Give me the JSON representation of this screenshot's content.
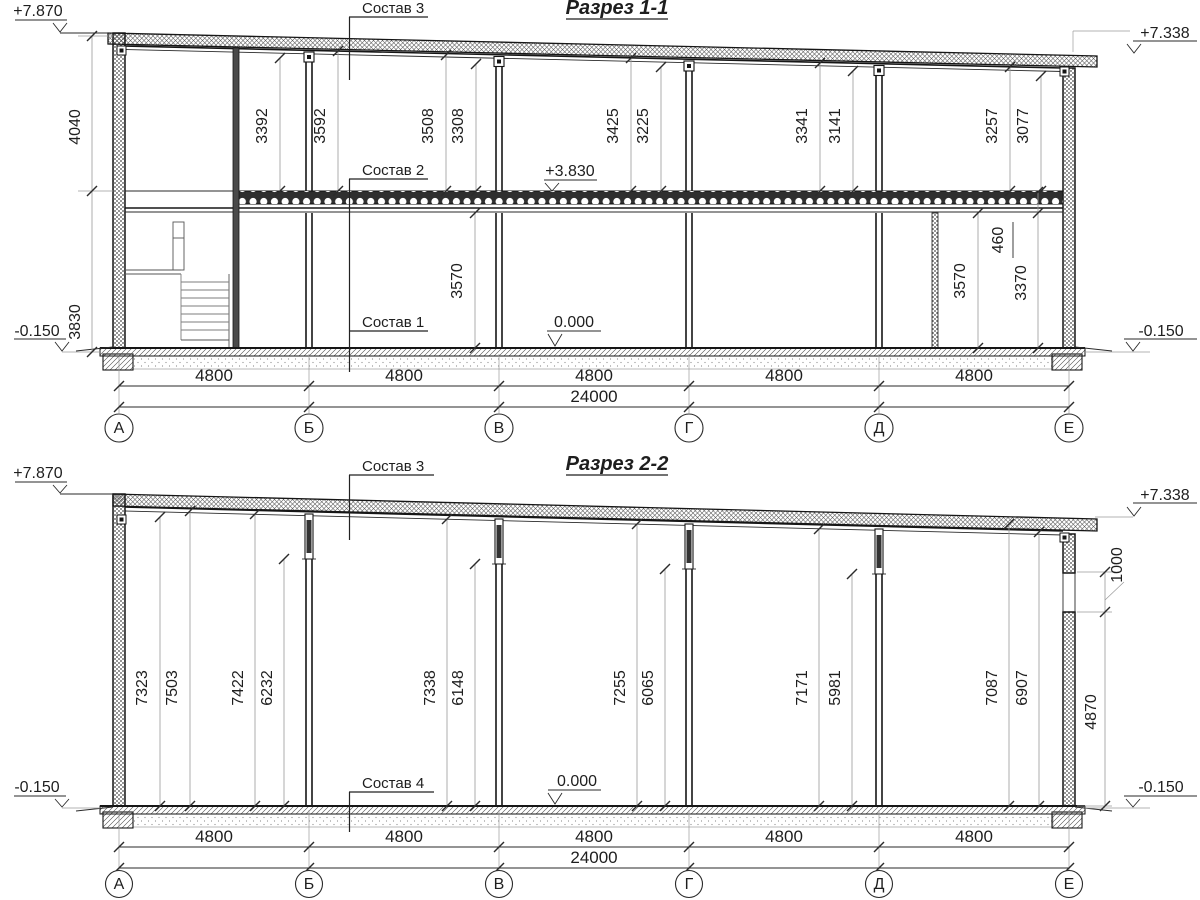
{
  "drawing": {
    "s1": {
      "title": "Разрез 1-1",
      "labels": {
        "l1": "Состав 1",
        "l2": "Состав 2",
        "l3": "Состав 3"
      },
      "elev": {
        "tl": "+7.870",
        "tr": "+7.338",
        "bl": "-0.150",
        "br": "-0.150",
        "zero": "0.000",
        "mid": "+3.830"
      },
      "side": {
        "upper": "4040",
        "lower": "3830"
      },
      "up": [
        "3392",
        "3592",
        "3508",
        "3308",
        "3425",
        "3225",
        "3341",
        "3141",
        "3257",
        "3077"
      ],
      "low": {
        "a": "3570",
        "b": "3570",
        "c": "3370",
        "d": "460"
      },
      "span": [
        "4800",
        "4800",
        "4800",
        "4800",
        "4800"
      ],
      "total": "24000",
      "axes": [
        "А",
        "Б",
        "В",
        "Г",
        "Д",
        "Е"
      ]
    },
    "s2": {
      "title": "Разрез 2-2",
      "labels": {
        "l3": "Состав 3",
        "l4": "Состав 4"
      },
      "elev": {
        "tl": "+7.870",
        "tr": "+7.338",
        "bl": "-0.150",
        "br": "-0.150",
        "zero": "0.000"
      },
      "h": [
        "7323",
        "7503",
        "7422",
        "6232",
        "7338",
        "6148",
        "7255",
        "6065",
        "7171",
        "5981",
        "7087",
        "6907"
      ],
      "right": {
        "win": "1000",
        "wall": "4870"
      },
      "span": [
        "4800",
        "4800",
        "4800",
        "4800",
        "4800"
      ],
      "total": "24000",
      "axes": [
        "А",
        "Б",
        "В",
        "Г",
        "Д",
        "Е"
      ]
    }
  }
}
